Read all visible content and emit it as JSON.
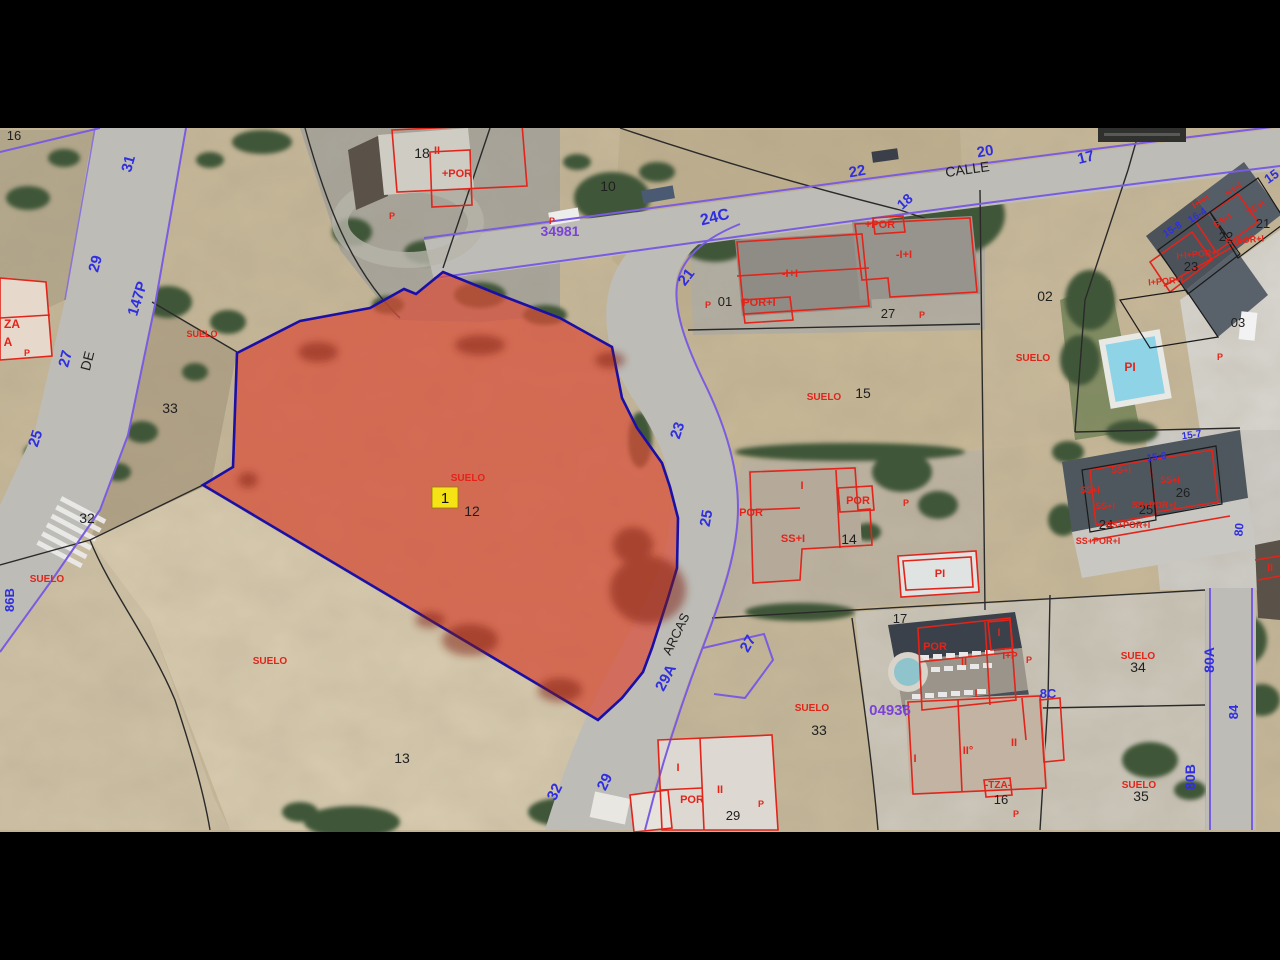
{
  "map": {
    "marker": {
      "label": "1"
    },
    "colors": {
      "blue": "#2f2fe0",
      "black": "#1f1f1f",
      "red": "#e2241a",
      "purple": "#7b42d8"
    },
    "labels": [
      {
        "t": "31",
        "x": 133,
        "y": 165,
        "r": -75,
        "c": "blue",
        "s": 15
      },
      {
        "t": "29",
        "x": 100,
        "y": 265,
        "r": -75,
        "c": "blue",
        "s": 15
      },
      {
        "t": "147P",
        "x": 142,
        "y": 300,
        "r": -73,
        "c": "blue",
        "s": 15
      },
      {
        "t": "27",
        "x": 70,
        "y": 360,
        "r": -75,
        "c": "blue",
        "s": 15
      },
      {
        "t": "25",
        "x": 40,
        "y": 440,
        "r": -72,
        "c": "blue",
        "s": 15
      },
      {
        "t": "86B",
        "x": 14,
        "y": 600,
        "r": -90,
        "c": "blue",
        "s": 13
      },
      {
        "t": "24C",
        "x": 716,
        "y": 222,
        "r": -14,
        "c": "blue",
        "s": 16
      },
      {
        "t": "21",
        "x": 690,
        "y": 280,
        "r": -52,
        "c": "blue",
        "s": 15
      },
      {
        "t": "18",
        "x": 908,
        "y": 205,
        "r": -42,
        "c": "blue",
        "s": 14
      },
      {
        "t": "22",
        "x": 858,
        "y": 176,
        "r": -10,
        "c": "blue",
        "s": 15
      },
      {
        "t": "20",
        "x": 986,
        "y": 156,
        "r": -10,
        "c": "blue",
        "s": 15
      },
      {
        "t": "17",
        "x": 1087,
        "y": 162,
        "r": -14,
        "c": "blue",
        "s": 15
      },
      {
        "t": "15",
        "x": 1274,
        "y": 180,
        "r": -35,
        "c": "blue",
        "s": 13
      },
      {
        "t": "16-4",
        "x": 1199,
        "y": 218,
        "r": -33,
        "c": "blue",
        "s": 10
      },
      {
        "t": "15-8",
        "x": 1174,
        "y": 232,
        "r": -33,
        "c": "blue",
        "s": 10
      },
      {
        "t": "15-7",
        "x": 1192,
        "y": 438,
        "r": -8,
        "c": "blue",
        "s": 10
      },
      {
        "t": "15-6",
        "x": 1157,
        "y": 460,
        "r": -8,
        "c": "blue",
        "s": 10
      },
      {
        "t": "80",
        "x": 1243,
        "y": 530,
        "r": -85,
        "c": "blue",
        "s": 12
      },
      {
        "t": "23",
        "x": 682,
        "y": 432,
        "r": -72,
        "c": "blue",
        "s": 15
      },
      {
        "t": "25",
        "x": 711,
        "y": 519,
        "r": -80,
        "c": "blue",
        "s": 15
      },
      {
        "t": "27",
        "x": 752,
        "y": 646,
        "r": -60,
        "c": "blue",
        "s": 15
      },
      {
        "t": "29A",
        "x": 670,
        "y": 680,
        "r": -62,
        "c": "blue",
        "s": 15
      },
      {
        "t": "29",
        "x": 609,
        "y": 784,
        "r": -64,
        "c": "blue",
        "s": 15
      },
      {
        "t": "32",
        "x": 559,
        "y": 794,
        "r": -64,
        "c": "blue",
        "s": 15
      },
      {
        "t": "80A",
        "x": 1214,
        "y": 660,
        "r": -90,
        "c": "blue",
        "s": 14
      },
      {
        "t": "84",
        "x": 1238,
        "y": 712,
        "r": -90,
        "c": "blue",
        "s": 13
      },
      {
        "t": "80B",
        "x": 1195,
        "y": 777,
        "r": -90,
        "c": "blue",
        "s": 14
      },
      {
        "t": "8C",
        "x": 1048,
        "y": 698,
        "r": 0,
        "c": "blue",
        "s": 13
      },
      {
        "t": "34981",
        "x": 560,
        "y": 236,
        "r": 0,
        "c": "purple",
        "s": 14
      },
      {
        "t": "04936",
        "x": 890,
        "y": 715,
        "r": 0,
        "c": "purple",
        "s": 15
      },
      {
        "t": "16",
        "x": 14,
        "y": 140,
        "r": 0,
        "c": "black",
        "s": 13,
        "w": "400"
      },
      {
        "t": "18",
        "x": 422,
        "y": 158,
        "r": 0,
        "c": "black",
        "s": 14,
        "w": "400"
      },
      {
        "t": "10",
        "x": 608,
        "y": 191,
        "r": 0,
        "c": "black",
        "s": 14,
        "w": "400"
      },
      {
        "t": "CALLE",
        "x": 968,
        "y": 174,
        "r": -8,
        "c": "black",
        "s": 14,
        "w": "400"
      },
      {
        "t": "DE",
        "x": 92,
        "y": 362,
        "r": -76,
        "c": "black",
        "s": 14,
        "w": "400"
      },
      {
        "t": "ARCAS",
        "x": 680,
        "y": 636,
        "r": -64,
        "c": "black",
        "s": 13,
        "w": "400"
      },
      {
        "t": "33",
        "x": 170,
        "y": 413,
        "r": 0,
        "c": "black",
        "s": 14,
        "w": "400"
      },
      {
        "t": "32",
        "x": 87,
        "y": 523,
        "r": 0,
        "c": "black",
        "s": 14,
        "w": "400"
      },
      {
        "t": "13",
        "x": 402,
        "y": 763,
        "r": 0,
        "c": "black",
        "s": 14,
        "w": "400"
      },
      {
        "t": "12",
        "x": 472,
        "y": 516,
        "r": 0,
        "c": "black",
        "s": 14,
        "w": "400"
      },
      {
        "t": "01",
        "x": 725,
        "y": 306,
        "r": 0,
        "c": "black",
        "s": 13,
        "w": "400"
      },
      {
        "t": "27",
        "x": 888,
        "y": 318,
        "r": 0,
        "c": "black",
        "s": 13,
        "w": "400"
      },
      {
        "t": "02",
        "x": 1045,
        "y": 301,
        "r": 0,
        "c": "black",
        "s": 14,
        "w": "400"
      },
      {
        "t": "15",
        "x": 863,
        "y": 398,
        "r": 0,
        "c": "black",
        "s": 14,
        "w": "400"
      },
      {
        "t": "14",
        "x": 849,
        "y": 544,
        "r": 0,
        "c": "black",
        "s": 14,
        "w": "400"
      },
      {
        "t": "17",
        "x": 900,
        "y": 623,
        "r": 0,
        "c": "black",
        "s": 13,
        "w": "400"
      },
      {
        "t": "16",
        "x": 1001,
        "y": 804,
        "r": 0,
        "c": "black",
        "s": 13,
        "w": "400"
      },
      {
        "t": "29",
        "x": 733,
        "y": 820,
        "r": 0,
        "c": "black",
        "s": 13,
        "w": "400"
      },
      {
        "t": "21",
        "x": 1263,
        "y": 228,
        "r": 0,
        "c": "black",
        "s": 13,
        "w": "400"
      },
      {
        "t": "22",
        "x": 1226,
        "y": 241,
        "r": 0,
        "c": "black",
        "s": 13,
        "w": "400"
      },
      {
        "t": "23",
        "x": 1191,
        "y": 271,
        "r": 0,
        "c": "black",
        "s": 13,
        "w": "400"
      },
      {
        "t": "03",
        "x": 1238,
        "y": 327,
        "r": 0,
        "c": "black",
        "s": 13,
        "w": "400"
      },
      {
        "t": "24",
        "x": 1106,
        "y": 529,
        "r": 0,
        "c": "black",
        "s": 13,
        "w": "400"
      },
      {
        "t": "25",
        "x": 1146,
        "y": 514,
        "r": 0,
        "c": "black",
        "s": 13,
        "w": "400"
      },
      {
        "t": "26",
        "x": 1183,
        "y": 497,
        "r": 0,
        "c": "black",
        "s": 13,
        "w": "400"
      },
      {
        "t": "34",
        "x": 1138,
        "y": 672,
        "r": 0,
        "c": "black",
        "s": 14,
        "w": "400"
      },
      {
        "t": "35",
        "x": 1141,
        "y": 801,
        "r": 0,
        "c": "black",
        "s": 14,
        "w": "400"
      },
      {
        "t": "33",
        "x": 819,
        "y": 735,
        "r": 0,
        "c": "black",
        "s": 14,
        "w": "400"
      },
      {
        "t": "SUELO",
        "x": 202,
        "y": 337,
        "r": 0,
        "c": "red",
        "s": 9
      },
      {
        "t": "SUELO",
        "x": 47,
        "y": 582,
        "r": 0,
        "c": "red",
        "s": 10
      },
      {
        "t": "SUELO",
        "x": 270,
        "y": 664,
        "r": 0,
        "c": "red",
        "s": 10
      },
      {
        "t": "SUELO",
        "x": 468,
        "y": 481,
        "r": 0,
        "c": "red",
        "s": 10
      },
      {
        "t": "SUELO",
        "x": 824,
        "y": 400,
        "r": 0,
        "c": "red",
        "s": 10
      },
      {
        "t": "SUELO",
        "x": 812,
        "y": 711,
        "r": 0,
        "c": "red",
        "s": 10
      },
      {
        "t": "SUELO",
        "x": 1033,
        "y": 361,
        "r": 0,
        "c": "red",
        "s": 10
      },
      {
        "t": "SUELO",
        "x": 1138,
        "y": 659,
        "r": 0,
        "c": "red",
        "s": 10
      },
      {
        "t": "SUELO",
        "x": 1139,
        "y": 788,
        "r": 0,
        "c": "red",
        "s": 10
      },
      {
        "t": "II",
        "x": 437,
        "y": 154,
        "r": 0,
        "c": "red",
        "s": 11
      },
      {
        "t": "+POR",
        "x": 457,
        "y": 177,
        "r": 0,
        "c": "red",
        "s": 11
      },
      {
        "t": "P",
        "x": 392,
        "y": 219,
        "r": 0,
        "c": "red",
        "s": 9
      },
      {
        "t": "P",
        "x": 552,
        "y": 224,
        "r": 0,
        "c": "red",
        "s": 9
      },
      {
        "t": "-I+I",
        "x": 790,
        "y": 277,
        "r": 0,
        "c": "red",
        "s": 11
      },
      {
        "t": "POR+I",
        "x": 759,
        "y": 306,
        "r": 0,
        "c": "red",
        "s": 11
      },
      {
        "t": "P",
        "x": 708,
        "y": 308,
        "r": 0,
        "c": "red",
        "s": 9
      },
      {
        "t": "+POR",
        "x": 880,
        "y": 228,
        "r": 0,
        "c": "red",
        "s": 11
      },
      {
        "t": "-I+I",
        "x": 904,
        "y": 258,
        "r": 0,
        "c": "red",
        "s": 11
      },
      {
        "t": "P",
        "x": 922,
        "y": 318,
        "r": 0,
        "c": "red",
        "s": 9
      },
      {
        "t": "I",
        "x": 802,
        "y": 489,
        "r": 0,
        "c": "red",
        "s": 11
      },
      {
        "t": "POR",
        "x": 858,
        "y": 504,
        "r": 0,
        "c": "red",
        "s": 11
      },
      {
        "t": "POR",
        "x": 751,
        "y": 516,
        "r": 0,
        "c": "red",
        "s": 11
      },
      {
        "t": "SS+I",
        "x": 793,
        "y": 542,
        "r": 0,
        "c": "red",
        "s": 11
      },
      {
        "t": "P",
        "x": 906,
        "y": 506,
        "r": 0,
        "c": "red",
        "s": 9
      },
      {
        "t": "PI",
        "x": 940,
        "y": 577,
        "r": 0,
        "c": "red",
        "s": 11
      },
      {
        "t": "P",
        "x": 1220,
        "y": 360,
        "r": 0,
        "c": "red",
        "s": 9
      },
      {
        "t": "PI",
        "x": 1130,
        "y": 371,
        "r": 0,
        "c": "red",
        "s": 12
      },
      {
        "t": "POR",
        "x": 935,
        "y": 650,
        "r": 0,
        "c": "red",
        "s": 11
      },
      {
        "t": "I",
        "x": 999,
        "y": 636,
        "r": 0,
        "c": "red",
        "s": 11
      },
      {
        "t": "II",
        "x": 964,
        "y": 665,
        "r": 0,
        "c": "red",
        "s": 11
      },
      {
        "t": "I+P",
        "x": 1010,
        "y": 659,
        "r": 0,
        "c": "red",
        "s": 10
      },
      {
        "t": "P",
        "x": 1029,
        "y": 663,
        "r": 0,
        "c": "red",
        "s": 9
      },
      {
        "t": "I",
        "x": 976,
        "y": 697,
        "r": 0,
        "c": "red",
        "s": 11
      },
      {
        "t": "I",
        "x": 915,
        "y": 762,
        "r": 0,
        "c": "red",
        "s": 11
      },
      {
        "t": "II°",
        "x": 968,
        "y": 754,
        "r": 0,
        "c": "red",
        "s": 11
      },
      {
        "t": "II",
        "x": 1014,
        "y": 746,
        "r": 0,
        "c": "red",
        "s": 11
      },
      {
        "t": "-TZA-",
        "x": 998,
        "y": 788,
        "r": 0,
        "c": "red",
        "s": 10
      },
      {
        "t": "P",
        "x": 1016,
        "y": 817,
        "r": 0,
        "c": "red",
        "s": 9
      },
      {
        "t": "I",
        "x": 678,
        "y": 771,
        "r": 0,
        "c": "red",
        "s": 11
      },
      {
        "t": "POR",
        "x": 692,
        "y": 803,
        "r": 0,
        "c": "red",
        "s": 11
      },
      {
        "t": "II",
        "x": 720,
        "y": 793,
        "r": 0,
        "c": "red",
        "s": 11
      },
      {
        "t": "P",
        "x": 761,
        "y": 807,
        "r": 0,
        "c": "red",
        "s": 9
      },
      {
        "t": "ZA",
        "x": 12,
        "y": 328,
        "r": 0,
        "c": "red",
        "s": 12
      },
      {
        "t": "A",
        "x": 8,
        "y": 346,
        "r": 0,
        "c": "red",
        "s": 12
      },
      {
        "t": "P",
        "x": 27,
        "y": 356,
        "r": 0,
        "c": "red",
        "s": 9
      },
      {
        "t": "I+I+I",
        "x": 1235,
        "y": 192,
        "r": -32,
        "c": "red",
        "s": 9
      },
      {
        "t": "SS+I",
        "x": 1257,
        "y": 210,
        "r": -32,
        "c": "red",
        "s": 9
      },
      {
        "t": "I+I+I",
        "x": 1202,
        "y": 204,
        "r": -32,
        "c": "red",
        "s": 9
      },
      {
        "t": "SS+I",
        "x": 1224,
        "y": 223,
        "r": -32,
        "c": "red",
        "s": 9
      },
      {
        "t": "S+POR+I",
        "x": 1245,
        "y": 243,
        "r": -5,
        "c": "red",
        "s": 9
      },
      {
        "t": "I+I+POR+I",
        "x": 1198,
        "y": 257,
        "r": -5,
        "c": "red",
        "s": 9
      },
      {
        "t": "I+POR+I",
        "x": 1166,
        "y": 284,
        "r": -5,
        "c": "red",
        "s": 9
      },
      {
        "t": "SS+I",
        "x": 1170,
        "y": 483,
        "r": 0,
        "c": "red",
        "s": 9
      },
      {
        "t": "SS+I",
        "x": 1121,
        "y": 473,
        "r": 0,
        "c": "red",
        "s": 9
      },
      {
        "t": "SS+I",
        "x": 1090,
        "y": 493,
        "r": 0,
        "c": "red",
        "s": 9
      },
      {
        "t": "SS+I",
        "x": 1105,
        "y": 509,
        "r": 0,
        "c": "red",
        "s": 9
      },
      {
        "t": "SS+POR+I",
        "x": 1154,
        "y": 508,
        "r": 0,
        "c": "red",
        "s": 9
      },
      {
        "t": "SS+POR+I",
        "x": 1128,
        "y": 528,
        "r": 0,
        "c": "red",
        "s": 9
      },
      {
        "t": "SS+POR+I",
        "x": 1098,
        "y": 544,
        "r": 0,
        "c": "red",
        "s": 9
      },
      {
        "t": "II",
        "x": 1270,
        "y": 571,
        "r": 0,
        "c": "red",
        "s": 11
      }
    ]
  }
}
